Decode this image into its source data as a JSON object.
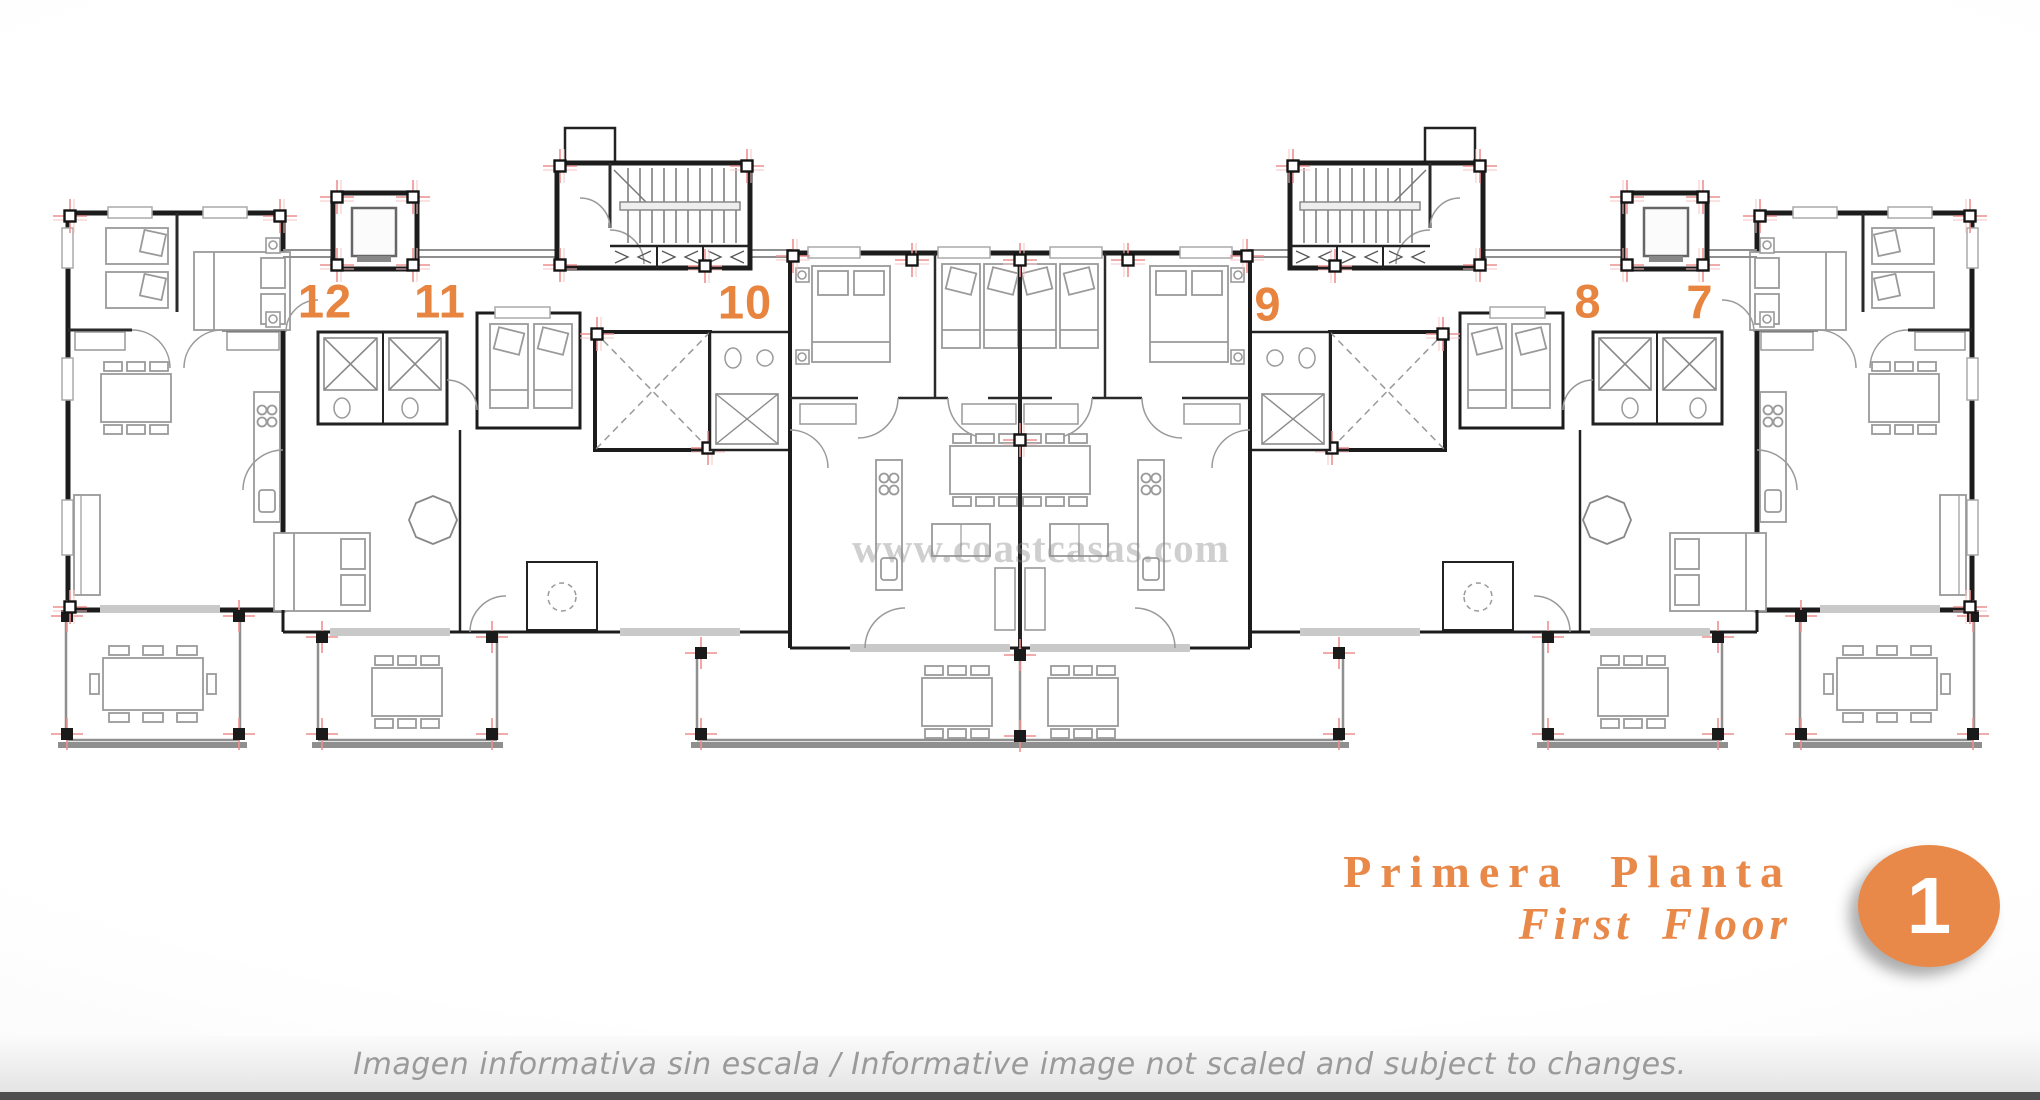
{
  "plan": {
    "watermark": "www.coastcasas.com",
    "units": [
      {
        "label": "12"
      },
      {
        "label": "11"
      },
      {
        "label": "10"
      },
      {
        "label": "9"
      },
      {
        "label": "8"
      },
      {
        "label": "7"
      }
    ]
  },
  "title": {
    "primary": "Primera Planta",
    "secondary": "First Floor",
    "badge": "1"
  },
  "footer": {
    "note": "Imagen informativa sin escala /  Informative image not scaled and subject to changes."
  },
  "colors": {
    "accent_orange": "#E8894A",
    "unit_number_orange": "#E78440",
    "wall_black": "#1C1C1C",
    "interior_wall": "#2A2A2A",
    "furniture_gray": "#9A9A9A",
    "terrace_gray": "#8F8F8F",
    "marker_red": "#EE8F8F",
    "watermark_gray": "#8F8F8F",
    "footer_text_gray": "#9A9A9A",
    "footer_strip_gray": "#4E4E4E"
  }
}
